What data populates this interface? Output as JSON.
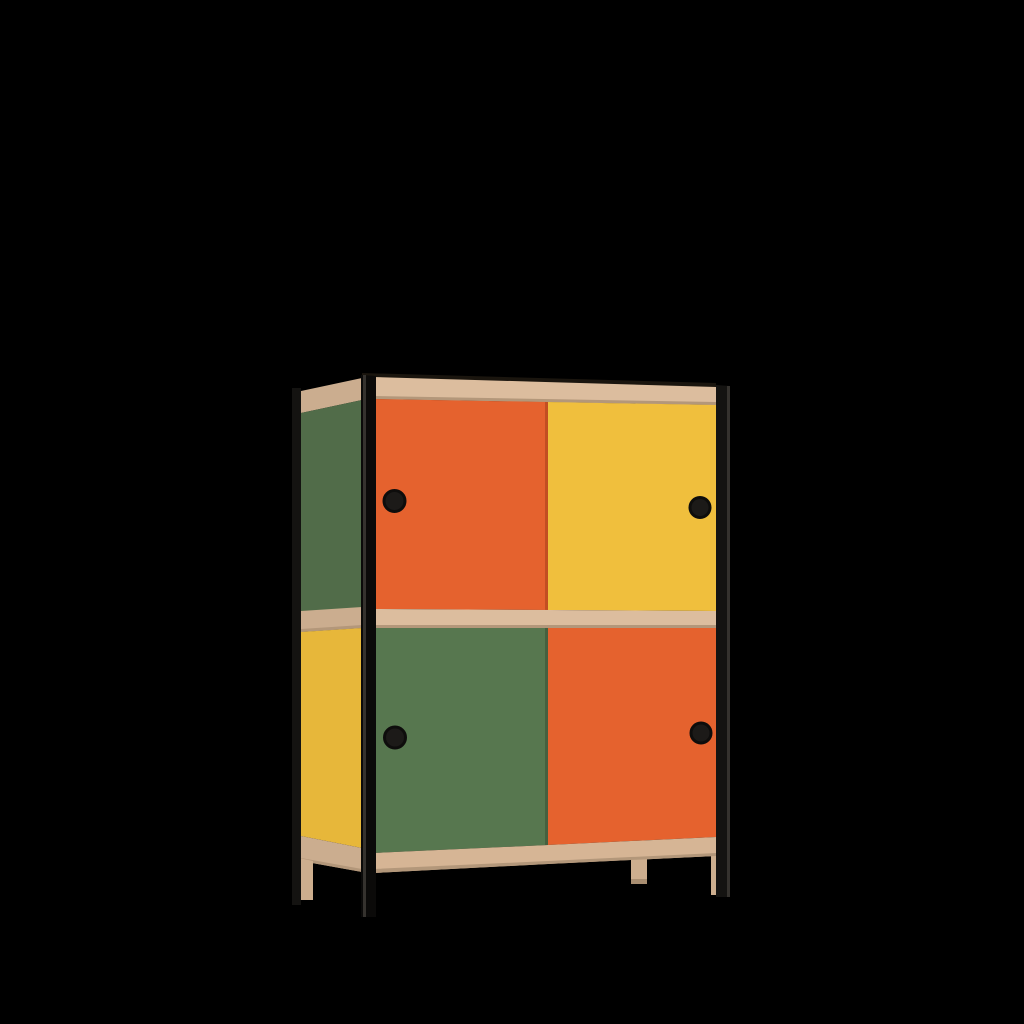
{
  "scene": {
    "description": "3D product render of a two-tier modular cabinet with colored sliding doors, black tubular frame and plywood shelves, centered on a black background",
    "background": "#000000"
  },
  "colors": {
    "background": "#000000",
    "frame_black": "#141311",
    "frame_black_deep": "#0b0a09",
    "frame_highlight": "#35322e",
    "plywood_front": "#DCBD9E",
    "plywood_side": "#CBAD8F",
    "plywood_bottom": "#D6B595",
    "plywood_edge": "#B3977A",
    "top_edge_dark": "#1A150E",
    "orange": "#E5622E",
    "orange_shadow": "#C24E22",
    "yellow": "#F0BF3D",
    "yellow_side": "#E7B73A",
    "green": "#57774F",
    "green_side": "#516C49",
    "green_shadow": "#46603F",
    "knob": "#1C1A18",
    "knob_rim": "#0E0D0C",
    "wood_leg": "#CDAE8E",
    "wood_leg_shadow": "#A98E71"
  },
  "cabinet": {
    "rows": 2,
    "columns": 2,
    "front_doors": [
      {
        "position": "top-left",
        "color_name": "orange",
        "knob": true
      },
      {
        "position": "top-right",
        "color_name": "yellow",
        "knob": true
      },
      {
        "position": "bottom-left",
        "color_name": "green",
        "knob": true
      },
      {
        "position": "bottom-right",
        "color_name": "orange",
        "knob": true
      }
    ],
    "side_panels": [
      {
        "position": "top",
        "color_name": "green"
      },
      {
        "position": "bottom",
        "color_name": "yellow"
      }
    ],
    "shelf_bands": 3,
    "knob_count": 4,
    "legs": {
      "metal": 3,
      "wood": 3
    }
  }
}
